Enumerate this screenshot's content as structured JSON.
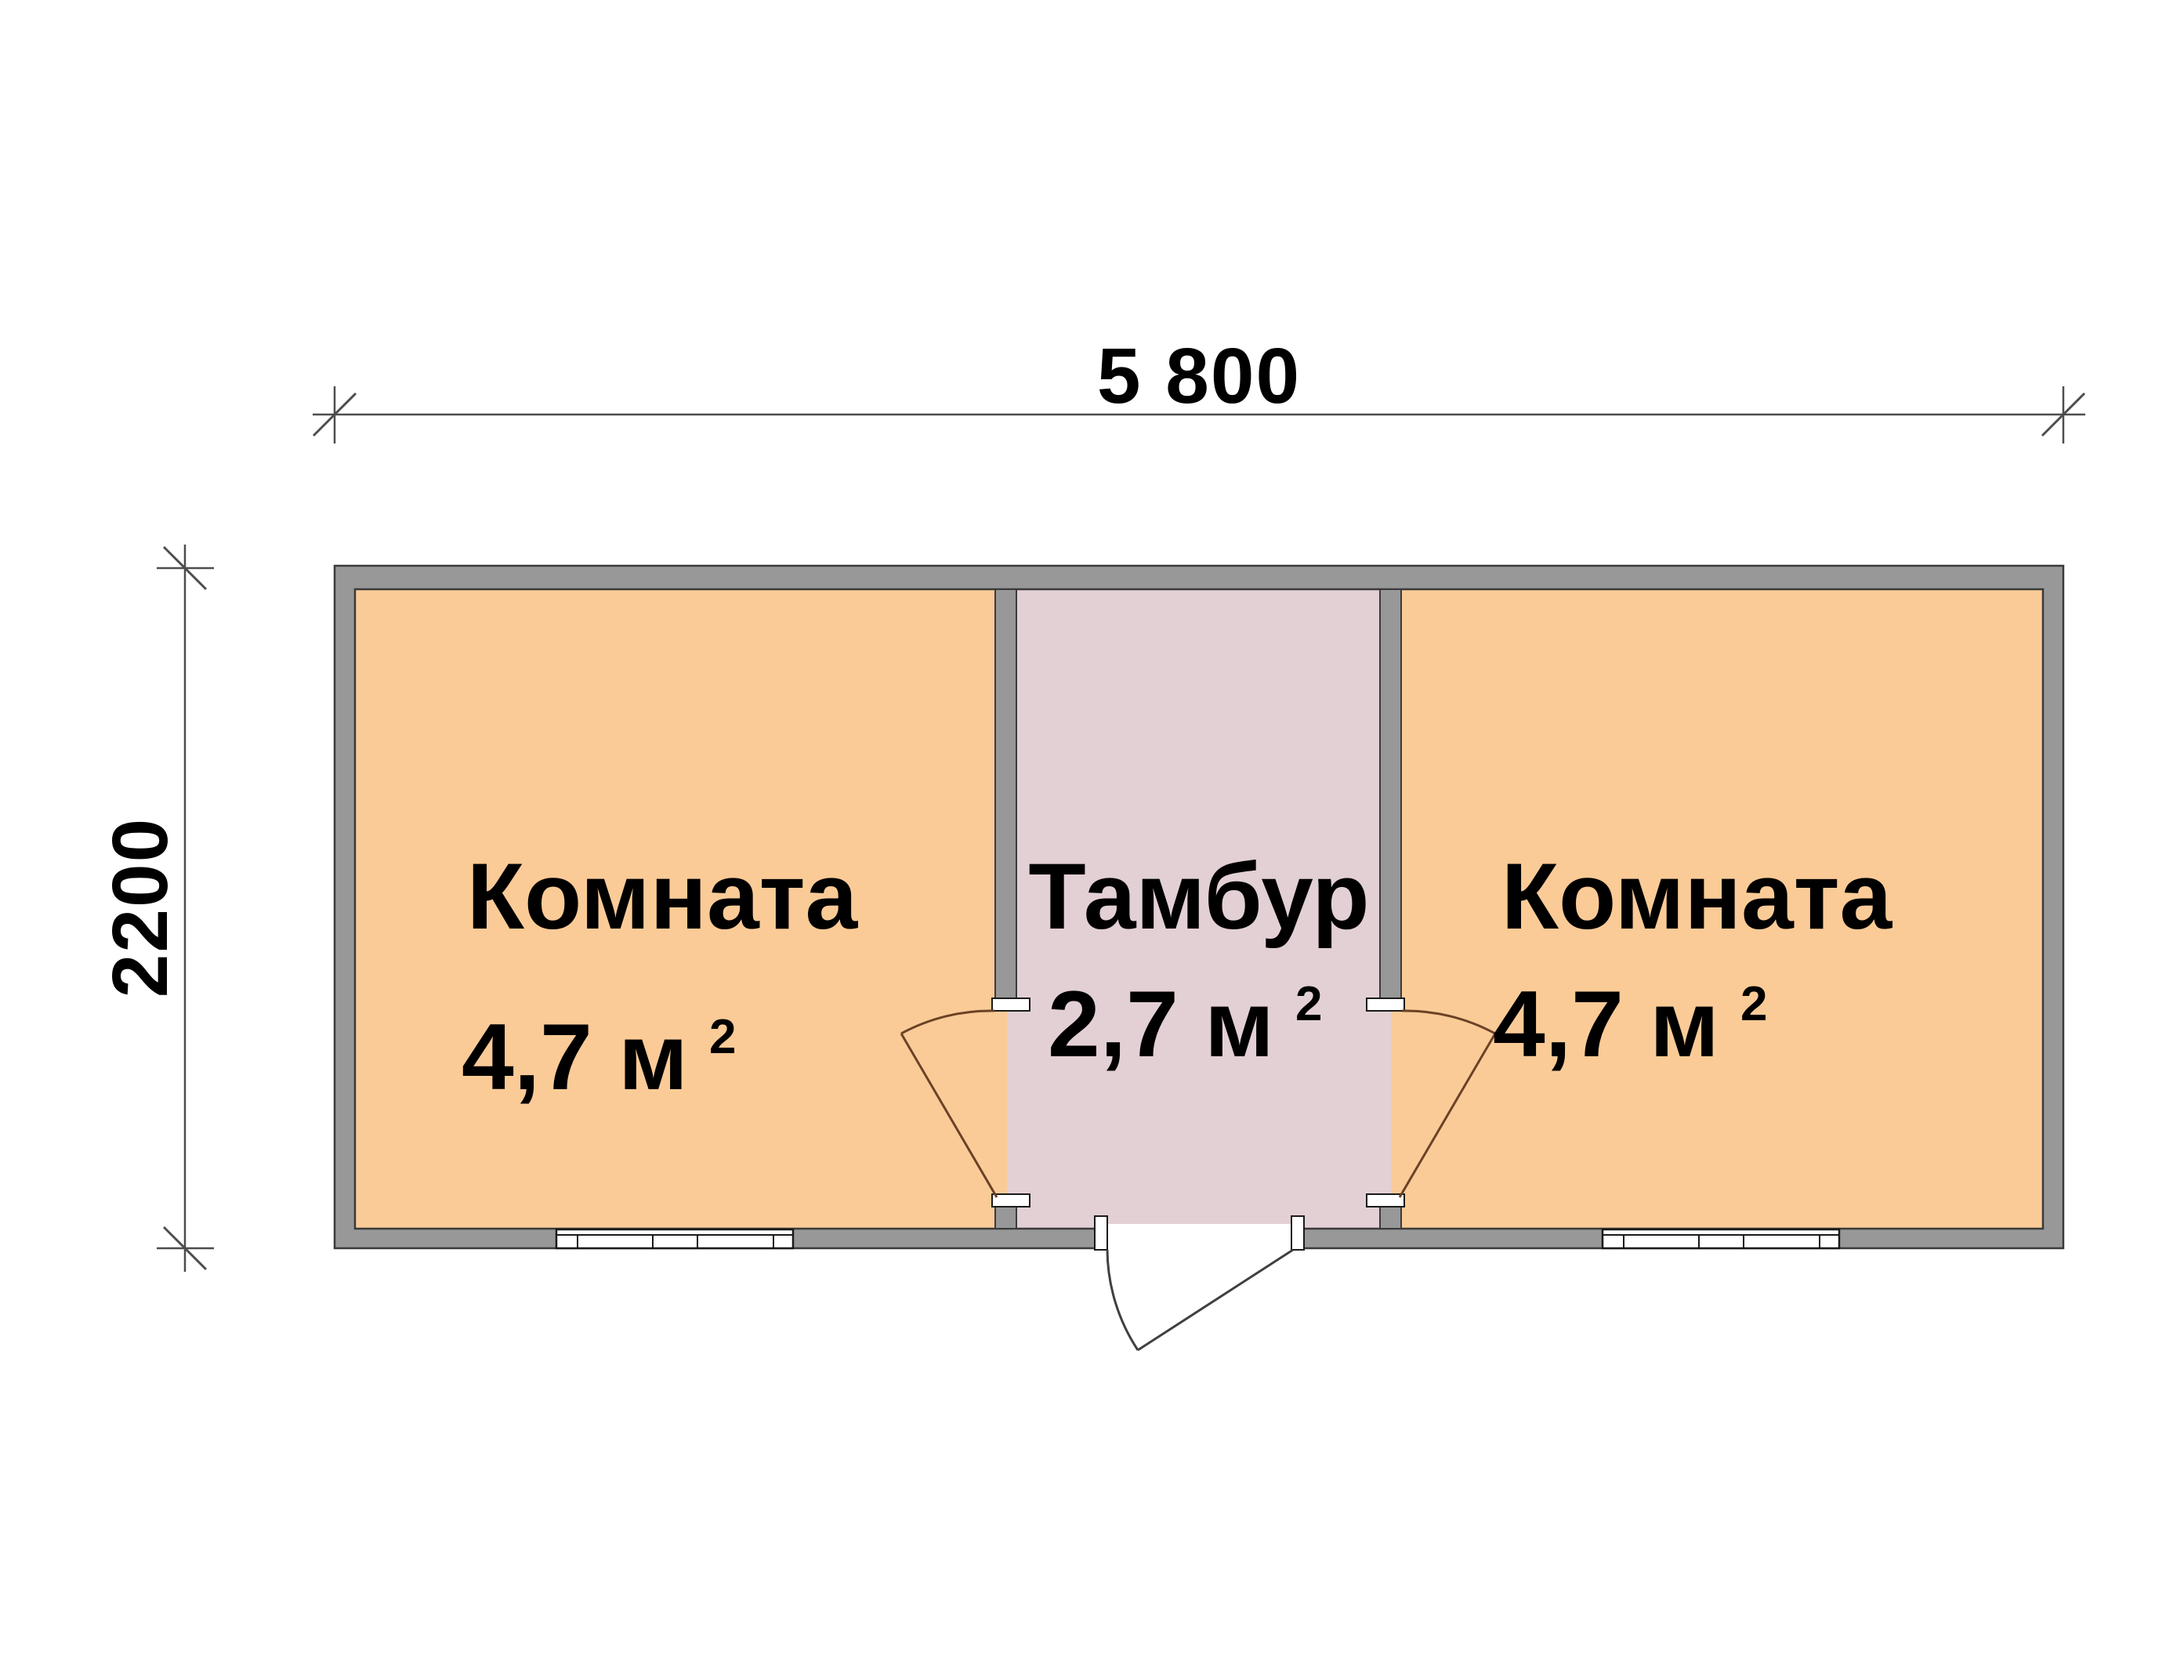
{
  "plan": {
    "dimensions": {
      "width_label": "5 800",
      "height_label": "2200"
    },
    "rooms": [
      {
        "name": "Комната",
        "area_base": "4,7 м",
        "area_exp": "2"
      },
      {
        "name": "Тамбур",
        "area_base": "2,7 м",
        "area_exp": "2"
      },
      {
        "name": "Комната",
        "area_base": "4,7 м",
        "area_exp": "2"
      }
    ],
    "colors": {
      "room_fill": "#FBCB97",
      "vestibule_fill": "#E3D0D4",
      "wall_fill": "#989898",
      "wall_outline": "#3A3A3A",
      "window_line": "#1A1A1A",
      "opening_fill": "#FFFFFF",
      "interior_door_line": "#6B4226",
      "entrance_door_line": "#404040",
      "dimension_line": "#4D4D4D"
    }
  }
}
